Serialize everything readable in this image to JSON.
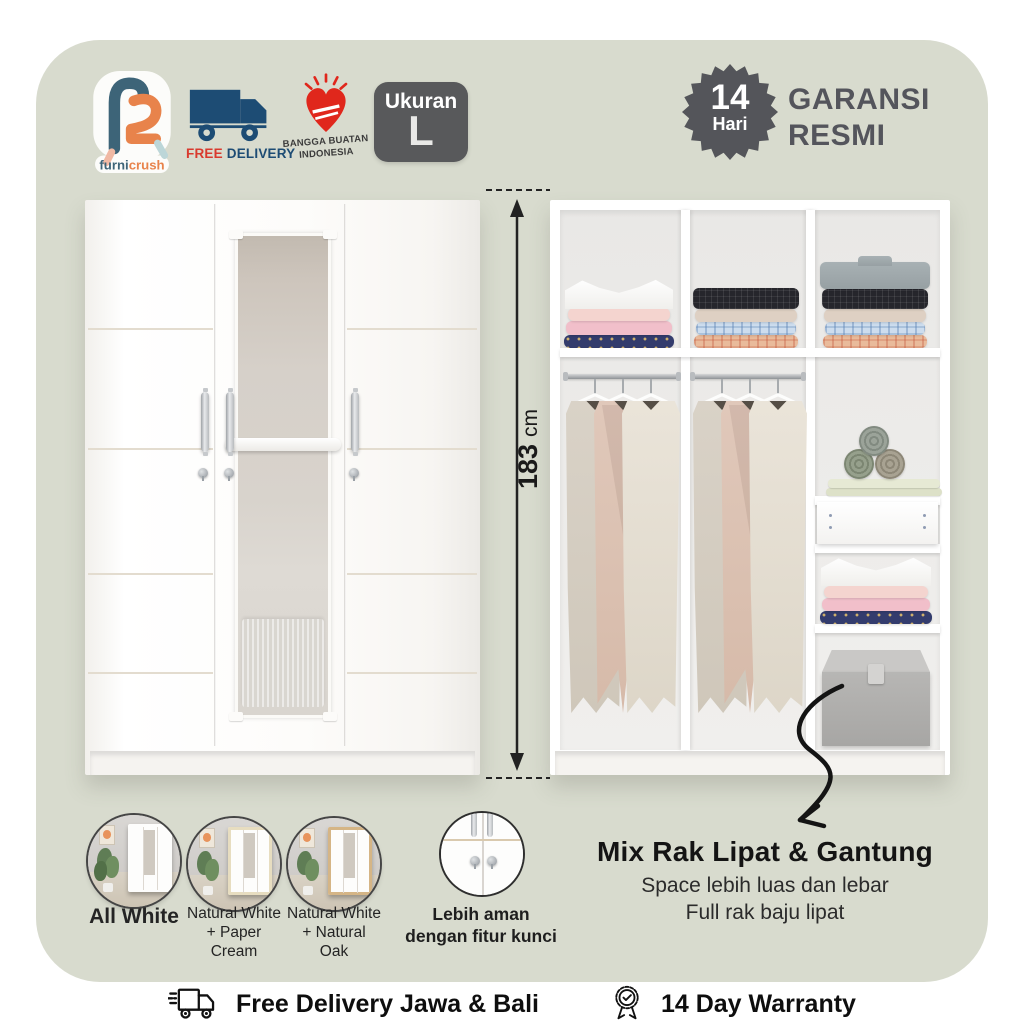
{
  "header": {
    "logo": {
      "furni": "furni",
      "crush": "crush"
    },
    "free_delivery": {
      "word1": "FREE",
      "word2": "DELIVERY"
    },
    "bangga": {
      "line1": "BANGGA BUATAN",
      "line2": "INDONESIA"
    },
    "size": {
      "label": "Ukuran",
      "value": "L"
    },
    "seal": {
      "number": "14",
      "unit": "Hari"
    },
    "guarantee": {
      "line1": "GARANSI",
      "line2": "RESMI"
    }
  },
  "dimension": {
    "value": "183",
    "unit": "cm"
  },
  "variants": [
    {
      "name": "all-white",
      "lines": [
        "All White"
      ]
    },
    {
      "name": "natural-white-paper-cream",
      "lines": [
        "Natural White",
        "+ Paper",
        "Cream"
      ]
    },
    {
      "name": "natural-white-natural-oak",
      "lines": [
        "Natural White",
        "+ Natural",
        "Oak"
      ]
    }
  ],
  "lock_feature": {
    "line1": "Lebih aman",
    "line2": "dengan fitur kunci"
  },
  "callout": {
    "title": "Mix Rak Lipat & Gantung",
    "line1": "Space lebih luas dan lebar",
    "line2": "Full rak baju lipat"
  },
  "footer": {
    "delivery": "Free Delivery Jawa & Bali",
    "warranty": "14 Day Warranty"
  },
  "colors": {
    "panel_sage": "#d8dbce",
    "badge_dark": "#58595b",
    "logo_blue": "#3d6478",
    "logo_orange": "#e8834b",
    "truck_navy": "#1d4c74",
    "free_red": "#d93a2e",
    "heart_red": "#e0271c",
    "text_dark": "#1a1a1a"
  }
}
